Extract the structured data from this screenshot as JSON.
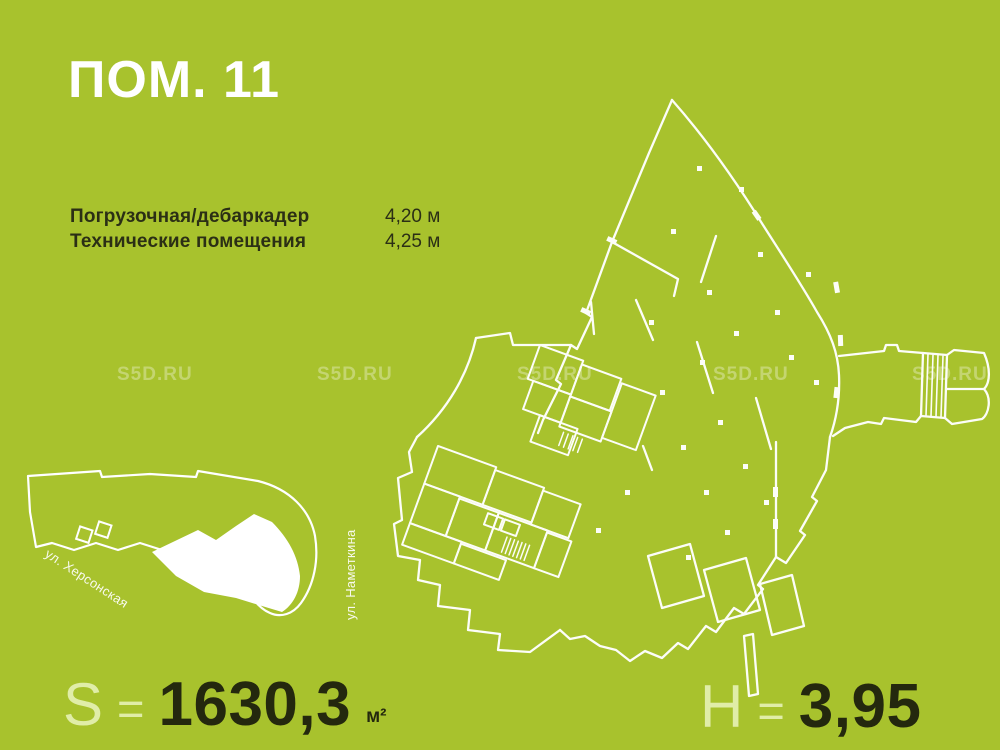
{
  "header": {
    "title": "ПОМ. 11"
  },
  "specs": {
    "rows": [
      {
        "label": "Погрузочная/дебаркадер",
        "value": "4,20 м"
      },
      {
        "label": "Технические помещения",
        "value": "4,25 м"
      }
    ]
  },
  "watermark": {
    "text": "S5D.RU"
  },
  "site_map": {
    "street_khersonskaya": "ул. Херсонская",
    "street_nametkina": "ул. Наметкина"
  },
  "footer": {
    "area_symbol": "S",
    "area_equals": "=",
    "area_value": "1630,3",
    "area_unit": "м²",
    "height_symbol": "H",
    "height_equals": "=",
    "height_value": "3,95"
  },
  "colors": {
    "background": "#a8c22d",
    "text_dark": "#2b2f15",
    "number_dark": "#24280e",
    "light_accent": "#e0eda8",
    "plan_lines": "#ffffff"
  }
}
